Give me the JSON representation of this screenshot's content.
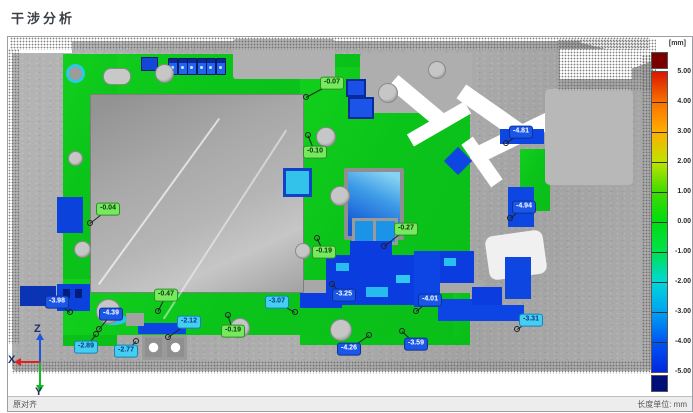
{
  "title": "干涉分析",
  "viewport": {
    "status_left": "原对齐",
    "status_right": "长度单位: mm"
  },
  "axis_triad": {
    "x_label": "X",
    "y_label": "Y",
    "z_label": "Z"
  },
  "colorbar": {
    "unit_label": "[mm]",
    "tick_labels": [
      "5.00",
      "4.00",
      "3.00",
      "2.00",
      "1.00",
      "0.00",
      "-1.00",
      "-2.00",
      "-3.00",
      "-4.00",
      "-5.00"
    ],
    "min": -5.0,
    "max": 5.0,
    "overflow_top_color": "#7a0000",
    "overflow_bottom_color": "#001078",
    "gradient_stops": [
      {
        "pos": 0,
        "color": "#d91800"
      },
      {
        "pos": 10,
        "color": "#f97100"
      },
      {
        "pos": 20,
        "color": "#ffae00"
      },
      {
        "pos": 30,
        "color": "#bfe300"
      },
      {
        "pos": 40,
        "color": "#3fdc00"
      },
      {
        "pos": 50,
        "color": "#00dc10"
      },
      {
        "pos": 60,
        "color": "#00e14e"
      },
      {
        "pos": 70,
        "color": "#00d8d8"
      },
      {
        "pos": 80,
        "color": "#00a2f2"
      },
      {
        "pos": 90,
        "color": "#0056f2"
      },
      {
        "pos": 100,
        "color": "#0026e2"
      }
    ]
  },
  "annotation_styles": {
    "near_zero": {
      "bg": "#76e95f",
      "border": "#2d8f28",
      "text": "#0d330a"
    },
    "mid_negative": {
      "bg": "#45cdf2",
      "border": "#1583b8",
      "text": "#093a80"
    },
    "strong_negative": {
      "bg": "#1b57e6",
      "border": "#0c2f9e",
      "text": "#ffffff"
    }
  },
  "annotations": [
    {
      "value": "-0.07",
      "style": "near_zero",
      "x": 332,
      "y": 83,
      "px": 306,
      "py": 97
    },
    {
      "value": "-0.10",
      "style": "near_zero",
      "x": 315,
      "y": 152,
      "px": 308,
      "py": 135
    },
    {
      "value": "-0.04",
      "style": "near_zero",
      "x": 108,
      "y": 209,
      "px": 90,
      "py": 223
    },
    {
      "value": "-0.27",
      "style": "near_zero",
      "x": 406,
      "y": 229,
      "px": 384,
      "py": 246
    },
    {
      "value": "-0.19",
      "style": "near_zero",
      "x": 324,
      "y": 252,
      "px": 317,
      "py": 238
    },
    {
      "value": "-0.47",
      "style": "near_zero",
      "x": 166,
      "y": 295,
      "px": 158,
      "py": 311
    },
    {
      "value": "-0.19",
      "style": "near_zero",
      "x": 233,
      "y": 331,
      "px": 228,
      "py": 315
    },
    {
      "value": "-4.81",
      "style": "strong_negative",
      "x": 521,
      "y": 132,
      "px": 506,
      "py": 143
    },
    {
      "value": "-4.94",
      "style": "strong_negative",
      "x": 524,
      "y": 207,
      "px": 510,
      "py": 218
    },
    {
      "value": "-3.98",
      "style": "strong_negative",
      "x": 57,
      "y": 302,
      "px": 70,
      "py": 312
    },
    {
      "value": "-3.25",
      "style": "strong_negative",
      "x": 344,
      "y": 295,
      "px": 332,
      "py": 284
    },
    {
      "value": "-4.01",
      "style": "strong_negative",
      "x": 430,
      "y": 300,
      "px": 416,
      "py": 311
    },
    {
      "value": "-4.39",
      "style": "strong_negative",
      "x": 111,
      "y": 314,
      "px": 99,
      "py": 329
    },
    {
      "value": "-4.26",
      "style": "strong_negative",
      "x": 349,
      "y": 349,
      "px": 369,
      "py": 335
    },
    {
      "value": "-3.59",
      "style": "strong_negative",
      "x": 416,
      "y": 344,
      "px": 402,
      "py": 331
    },
    {
      "value": "-3.07",
      "style": "mid_negative",
      "x": 277,
      "y": 302,
      "px": 295,
      "py": 312
    },
    {
      "value": "-2.12",
      "style": "mid_negative",
      "x": 189,
      "y": 322,
      "px": 168,
      "py": 337
    },
    {
      "value": "-2.89",
      "style": "mid_negative",
      "x": 86,
      "y": 347,
      "px": 96,
      "py": 334
    },
    {
      "value": "-2.77",
      "style": "mid_negative",
      "x": 126,
      "y": 351,
      "px": 136,
      "py": 341
    },
    {
      "value": "-3.31",
      "style": "mid_negative",
      "x": 531,
      "y": 320,
      "px": 517,
      "py": 329
    }
  ]
}
